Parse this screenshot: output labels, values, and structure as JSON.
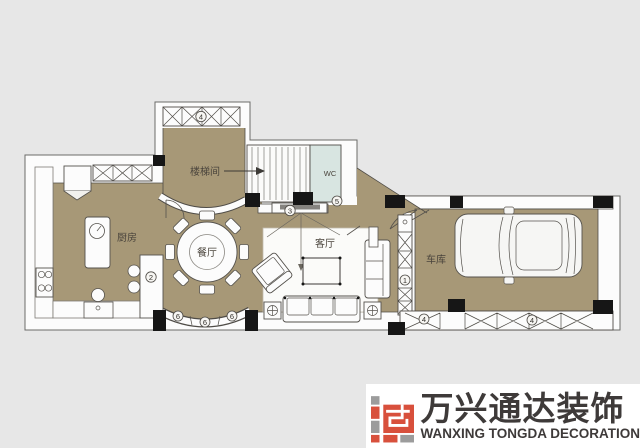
{
  "background": "#e7e7e7",
  "colors": {
    "floor": "#a79877",
    "wall_fill": "#fcfcfc",
    "line": "#4f4c47",
    "wc_fill": "#d8e5e1",
    "column": "#161616",
    "logo_red": "#d8503c",
    "logo_gray": "#9c9c9c",
    "logo_text": "#3e3a39"
  },
  "rooms": {
    "kitchen": "厨房",
    "dining": "餐厅",
    "living": "客厅",
    "garage": "车库",
    "stairwell": "楼梯间",
    "wc": "WC"
  },
  "markers": {
    "top_window": "4",
    "bar": "2",
    "tv": "3",
    "wc_door": "5",
    "divider": "1",
    "bay_left": "6",
    "bay_mid": "6",
    "bay_right": "6",
    "garage_left": "4",
    "garage_right": "4"
  },
  "logo": {
    "name_cn": "万兴通达装饰",
    "name_en": "WANXING TONGDA DECORATION"
  }
}
